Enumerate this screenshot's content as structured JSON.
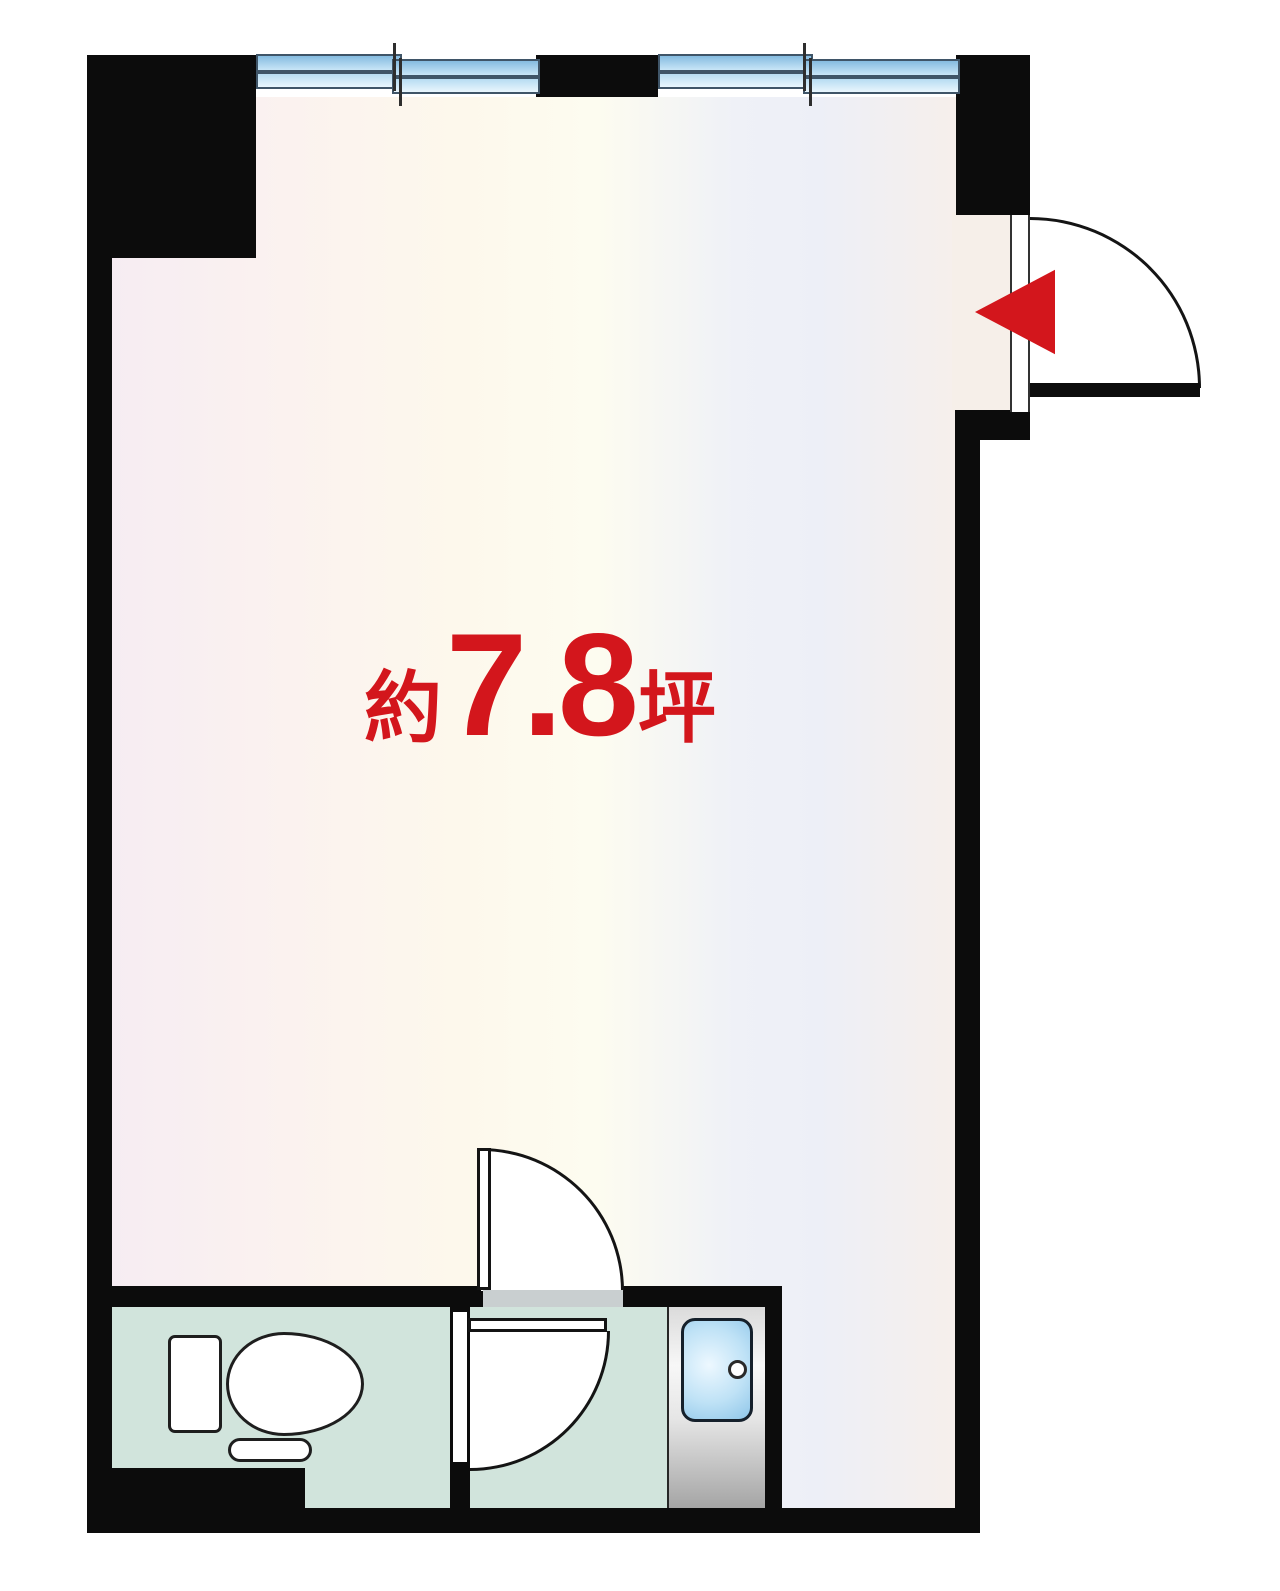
{
  "plan": {
    "area_label": {
      "prefix": "約",
      "value": "7.8",
      "unit": "坪"
    }
  },
  "colors": {
    "wall_black": "#0c0c0c",
    "area_label_red": "#d3161c",
    "wet_room_floor_mint": "#d1e4dc",
    "window_glass_blue": "#85bce0",
    "bathtub_blue": "#bfe2f6",
    "bath_unit_gray": "#c9c9c9",
    "threshold_gray": "#c9cfd0",
    "floor_gradient": [
      "#f6ecf3",
      "#fbf2ef",
      "#fdf8ec",
      "#fdfcf0",
      "#eff1f7",
      "#f6efeb"
    ]
  },
  "icons": {
    "entry_arrow": "red-left-pointing-triangle",
    "windows": "double-pane-sliding-window",
    "doors": "quarter-circle-swing-door",
    "fixtures": [
      "toilet",
      "bathtub-with-drain"
    ]
  }
}
